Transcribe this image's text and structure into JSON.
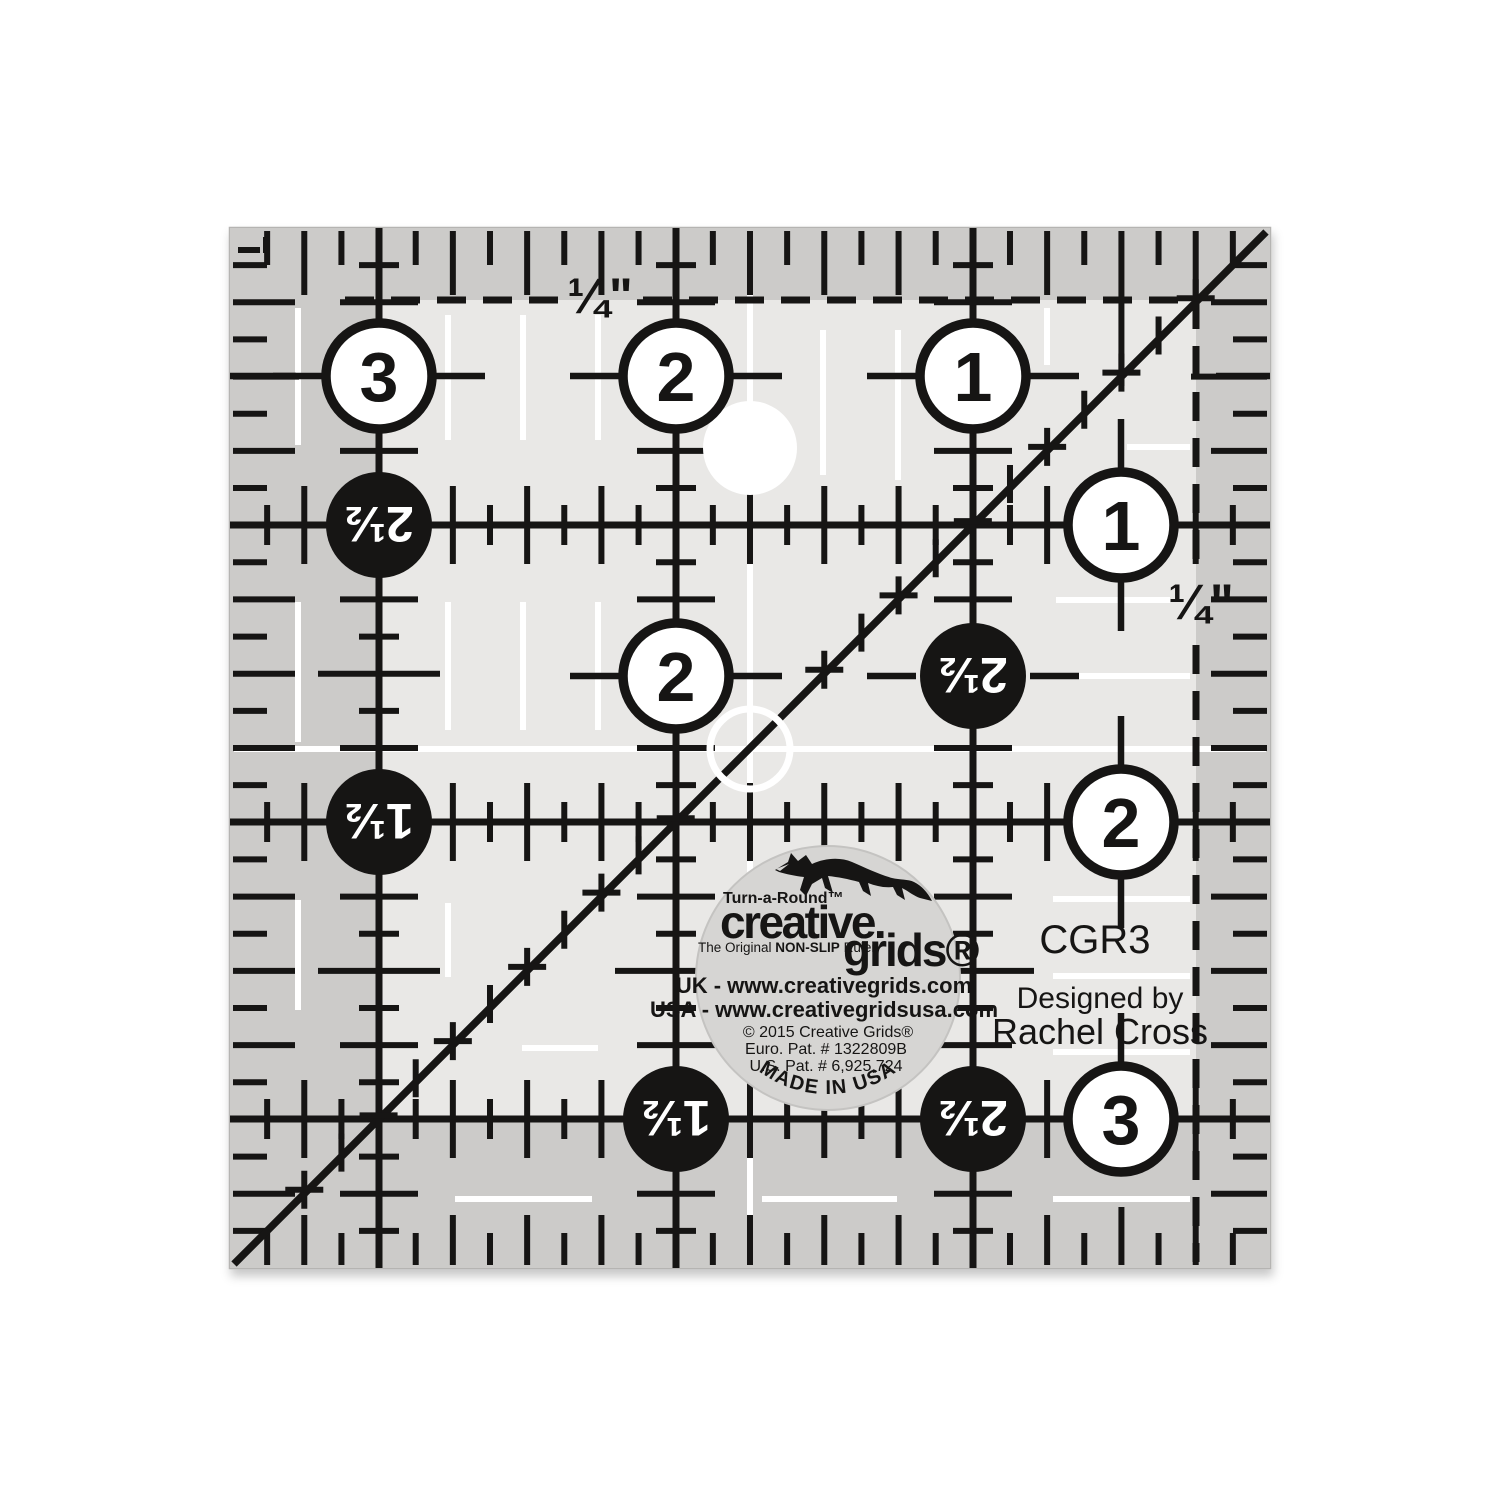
{
  "image": {
    "width": 1500,
    "height": 1500,
    "background": "#ffffff",
    "subject": "Creative Grids CGR3 3.5 inch square non-slip quilting ruler product photo"
  },
  "colors": {
    "ruler_body": "#e9e8e6",
    "grip_band": "#cccbc9",
    "ink": "#161514",
    "white_mark": "#ffffff",
    "sticker_fill": "#d6d5d3",
    "sticker_edge": "#c4c3c1",
    "ruler_edge": "#b5b4b2"
  },
  "geometry": {
    "left": 230,
    "top": 228,
    "right": 1270,
    "bottom": 1268,
    "px_per_inch": 297.14,
    "size_inches": 3.5,
    "main_vertical_x": [
      379,
      676,
      973
    ],
    "main_horizontal_y": [
      525,
      822,
      1119
    ],
    "diagonal": {
      "x1": 234,
      "y1": 1264,
      "x2": 1266,
      "y2": 232
    },
    "seam_dash_top_y": 300,
    "seam_dash_right_x": 1196,
    "sticker": {
      "cx": 828,
      "cy": 978,
      "r": 132
    }
  },
  "markings": {
    "quarter_label_top": {
      "text": "¼\"",
      "x": 600,
      "y": 295
    },
    "quarter_label_right": {
      "text": "¼\"",
      "x": 1201,
      "y": 601
    },
    "circles": [
      {
        "label": "3",
        "x": 379,
        "y": 376,
        "style": "white"
      },
      {
        "label": "2",
        "x": 676,
        "y": 376,
        "style": "white"
      },
      {
        "label": "1",
        "x": 973,
        "y": 376,
        "style": "white"
      },
      {
        "label": "2½",
        "x": 379,
        "y": 525,
        "style": "black"
      },
      {
        "label": "1",
        "x": 1121,
        "y": 525,
        "style": "white"
      },
      {
        "label": "2",
        "x": 676,
        "y": 676,
        "style": "white"
      },
      {
        "label": "2½",
        "x": 973,
        "y": 676,
        "style": "black"
      },
      {
        "label": "1½",
        "x": 379,
        "y": 822,
        "style": "black"
      },
      {
        "label": "2",
        "x": 1121,
        "y": 822,
        "style": "white"
      },
      {
        "label": "1½",
        "x": 676,
        "y": 1119,
        "style": "black"
      },
      {
        "label": "2½",
        "x": 973,
        "y": 1119,
        "style": "black"
      },
      {
        "label": "3",
        "x": 1121,
        "y": 1119,
        "style": "white"
      }
    ],
    "holes": {
      "hanging_hole": {
        "x": 750,
        "y": 448,
        "r": 47
      },
      "center_ring": {
        "x": 750,
        "y": 749,
        "r": 40
      }
    },
    "white_marks": {
      "center_vertical": {
        "x": 750,
        "y1": 233,
        "y2": 1262
      },
      "center_horizontal": {
        "y": 749,
        "x1": 234,
        "x2": 1266
      },
      "vertical_dashes": [
        {
          "x": 298,
          "segs": [
            [
              308,
              445
            ],
            [
              602,
              742
            ],
            [
              900,
              1010
            ]
          ]
        },
        {
          "x": 448,
          "segs": [
            [
              315,
              440
            ],
            [
              602,
              730
            ],
            [
              903,
              977
            ]
          ]
        },
        {
          "x": 523,
          "segs": [
            [
              315,
              440
            ],
            [
              602,
              730
            ]
          ]
        },
        {
          "x": 598,
          "segs": [
            [
              315,
              440
            ],
            [
              602,
              730
            ]
          ]
        },
        {
          "x": 823,
          "segs": [
            [
              330,
              475
            ]
          ]
        },
        {
          "x": 898,
          "segs": [
            [
              330,
              480
            ]
          ]
        },
        {
          "x": 1047,
          "segs": [
            [
              308,
              365
            ]
          ]
        }
      ],
      "horizontal_dashes": [
        {
          "y": 447,
          "segs": [
            [
              1127,
              1190
            ]
          ]
        },
        {
          "y": 600,
          "segs": [
            [
              1056,
              1170
            ]
          ]
        },
        {
          "y": 676,
          "segs": [
            [
              1053,
              1190
            ]
          ]
        },
        {
          "y": 899,
          "segs": [
            [
              1053,
              1190
            ]
          ]
        },
        {
          "y": 976,
          "segs": [
            [
              1053,
              1190
            ]
          ]
        },
        {
          "y": 1048,
          "segs": [
            [
              522,
              598
            ]
          ]
        },
        {
          "y": 1052,
          "segs": [
            [
              1053,
              1190
            ]
          ]
        },
        {
          "y": 1199,
          "segs": [
            [
              455,
              592
            ],
            [
              762,
              897
            ],
            [
              1053,
              1190
            ]
          ]
        }
      ]
    },
    "seam_lines": {
      "top": {
        "y": 300,
        "segments": [
          [
            345,
            565
          ],
          [
            643,
            1196
          ]
        ]
      },
      "right": {
        "x": 1196,
        "segments": [
          [
            300,
            567
          ],
          [
            645,
            1262
          ]
        ]
      }
    }
  },
  "side_text": {
    "model": "CGR3",
    "designed_by": "Designed by",
    "designer": "Rachel Cross"
  },
  "sticker": {
    "turnaround": "Turn-a-Round™",
    "brand_top": "creative.",
    "brand_bottom": "grids®",
    "tagline_prefix": "The Original ",
    "tagline_bold": "NON-SLIP",
    "tagline_suffix": " Ruler",
    "url_uk": "UK - www.creativegrids.com",
    "url_usa": "USA - www.creativegridsusa.com",
    "copyright": "© 2015 Creative Grids®",
    "euro_patent": "Euro. Pat. # 1322809B",
    "us_patent": "U.S. Pat. # 6,925,724",
    "made_in": "MADE IN USA"
  }
}
